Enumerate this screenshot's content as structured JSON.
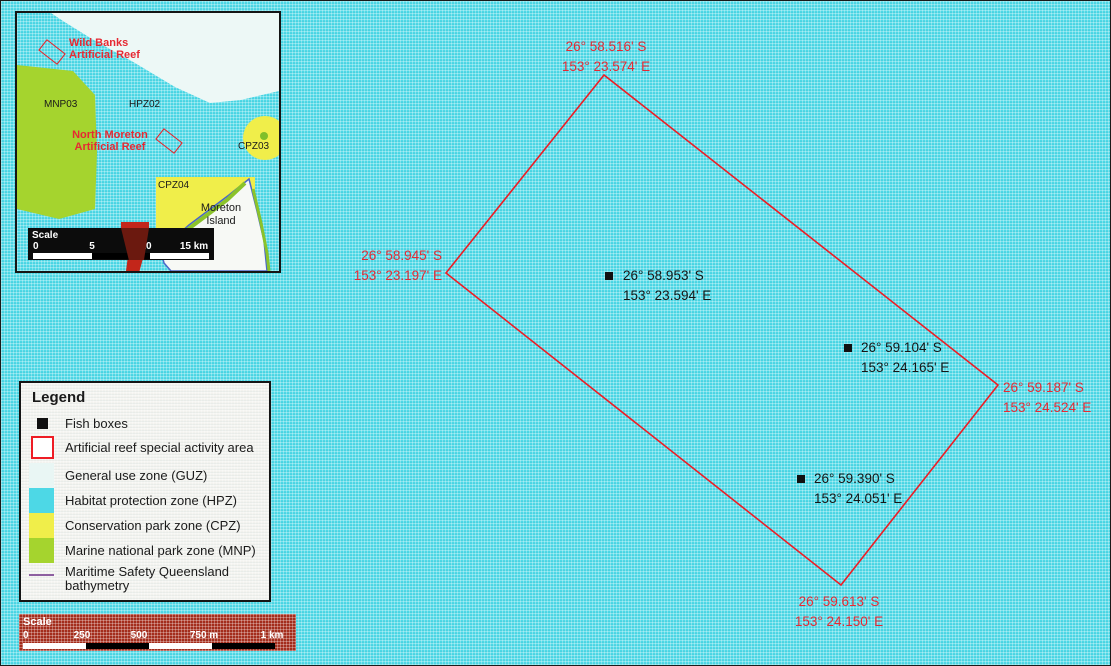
{
  "main_map": {
    "corners": [
      {
        "id": "north",
        "lat": "26° 58.516' S",
        "lon": "153° 23.574' E"
      },
      {
        "id": "west",
        "lat": "26° 58.945' S",
        "lon": "153° 23.197' E"
      },
      {
        "id": "east",
        "lat": "26° 59.187' S",
        "lon": "153° 24.524' E"
      },
      {
        "id": "south",
        "lat": "26° 59.613' S",
        "lon": "153° 24.150' E"
      }
    ],
    "fish_boxes": [
      {
        "lat": "26° 58.953' S",
        "lon": "153° 23.594' E"
      },
      {
        "lat": "26° 59.104' S",
        "lon": "153° 24.165' E"
      },
      {
        "lat": "26° 59.390' S",
        "lon": "153° 24.051' E"
      }
    ]
  },
  "inset": {
    "labels": {
      "wild_banks_1": "Wild Banks",
      "wild_banks_2": "Artificial Reef",
      "north_moreton_1": "North Moreton",
      "north_moreton_2": "Artificial Reef",
      "mnp03": "MNP03",
      "hpz02": "HPZ02",
      "cpz03": "CPZ03",
      "cpz04": "CPZ04",
      "island_1": "Moreton",
      "island_2": "Island"
    },
    "scale": {
      "title": "Scale",
      "ticks": [
        "0",
        "5",
        "10",
        "15 km"
      ]
    }
  },
  "legend": {
    "title": "Legend",
    "items": [
      {
        "label": "Fish boxes"
      },
      {
        "label": "Artificial reef special activity area"
      },
      {
        "label": "General use zone (GUZ)"
      },
      {
        "label": "Habitat protection zone (HPZ)"
      },
      {
        "label": "Conservation park zone (CPZ)"
      },
      {
        "label": "Marine national park zone (MNP)"
      },
      {
        "label": "Maritime Safety Queensland",
        "label2": "bathymetry"
      }
    ]
  },
  "scale_bar": {
    "title": "Scale",
    "ticks": [
      "0",
      "250",
      "500",
      "750 m",
      "1 km"
    ]
  },
  "colors": {
    "habitat_protection_zone": "#4dd8e6",
    "general_use_zone": "#e9f6f4",
    "conservation_park_zone": "#f0ee4a",
    "marine_national_park_zone": "#a5d42e",
    "reef_outline_red": "#ee1c24",
    "coordinate_label_red": "#e62933",
    "scale_box_red": "#a62c1b",
    "bathymetry_purple": "#8d5fa0",
    "fish_box_black": "#101010"
  }
}
